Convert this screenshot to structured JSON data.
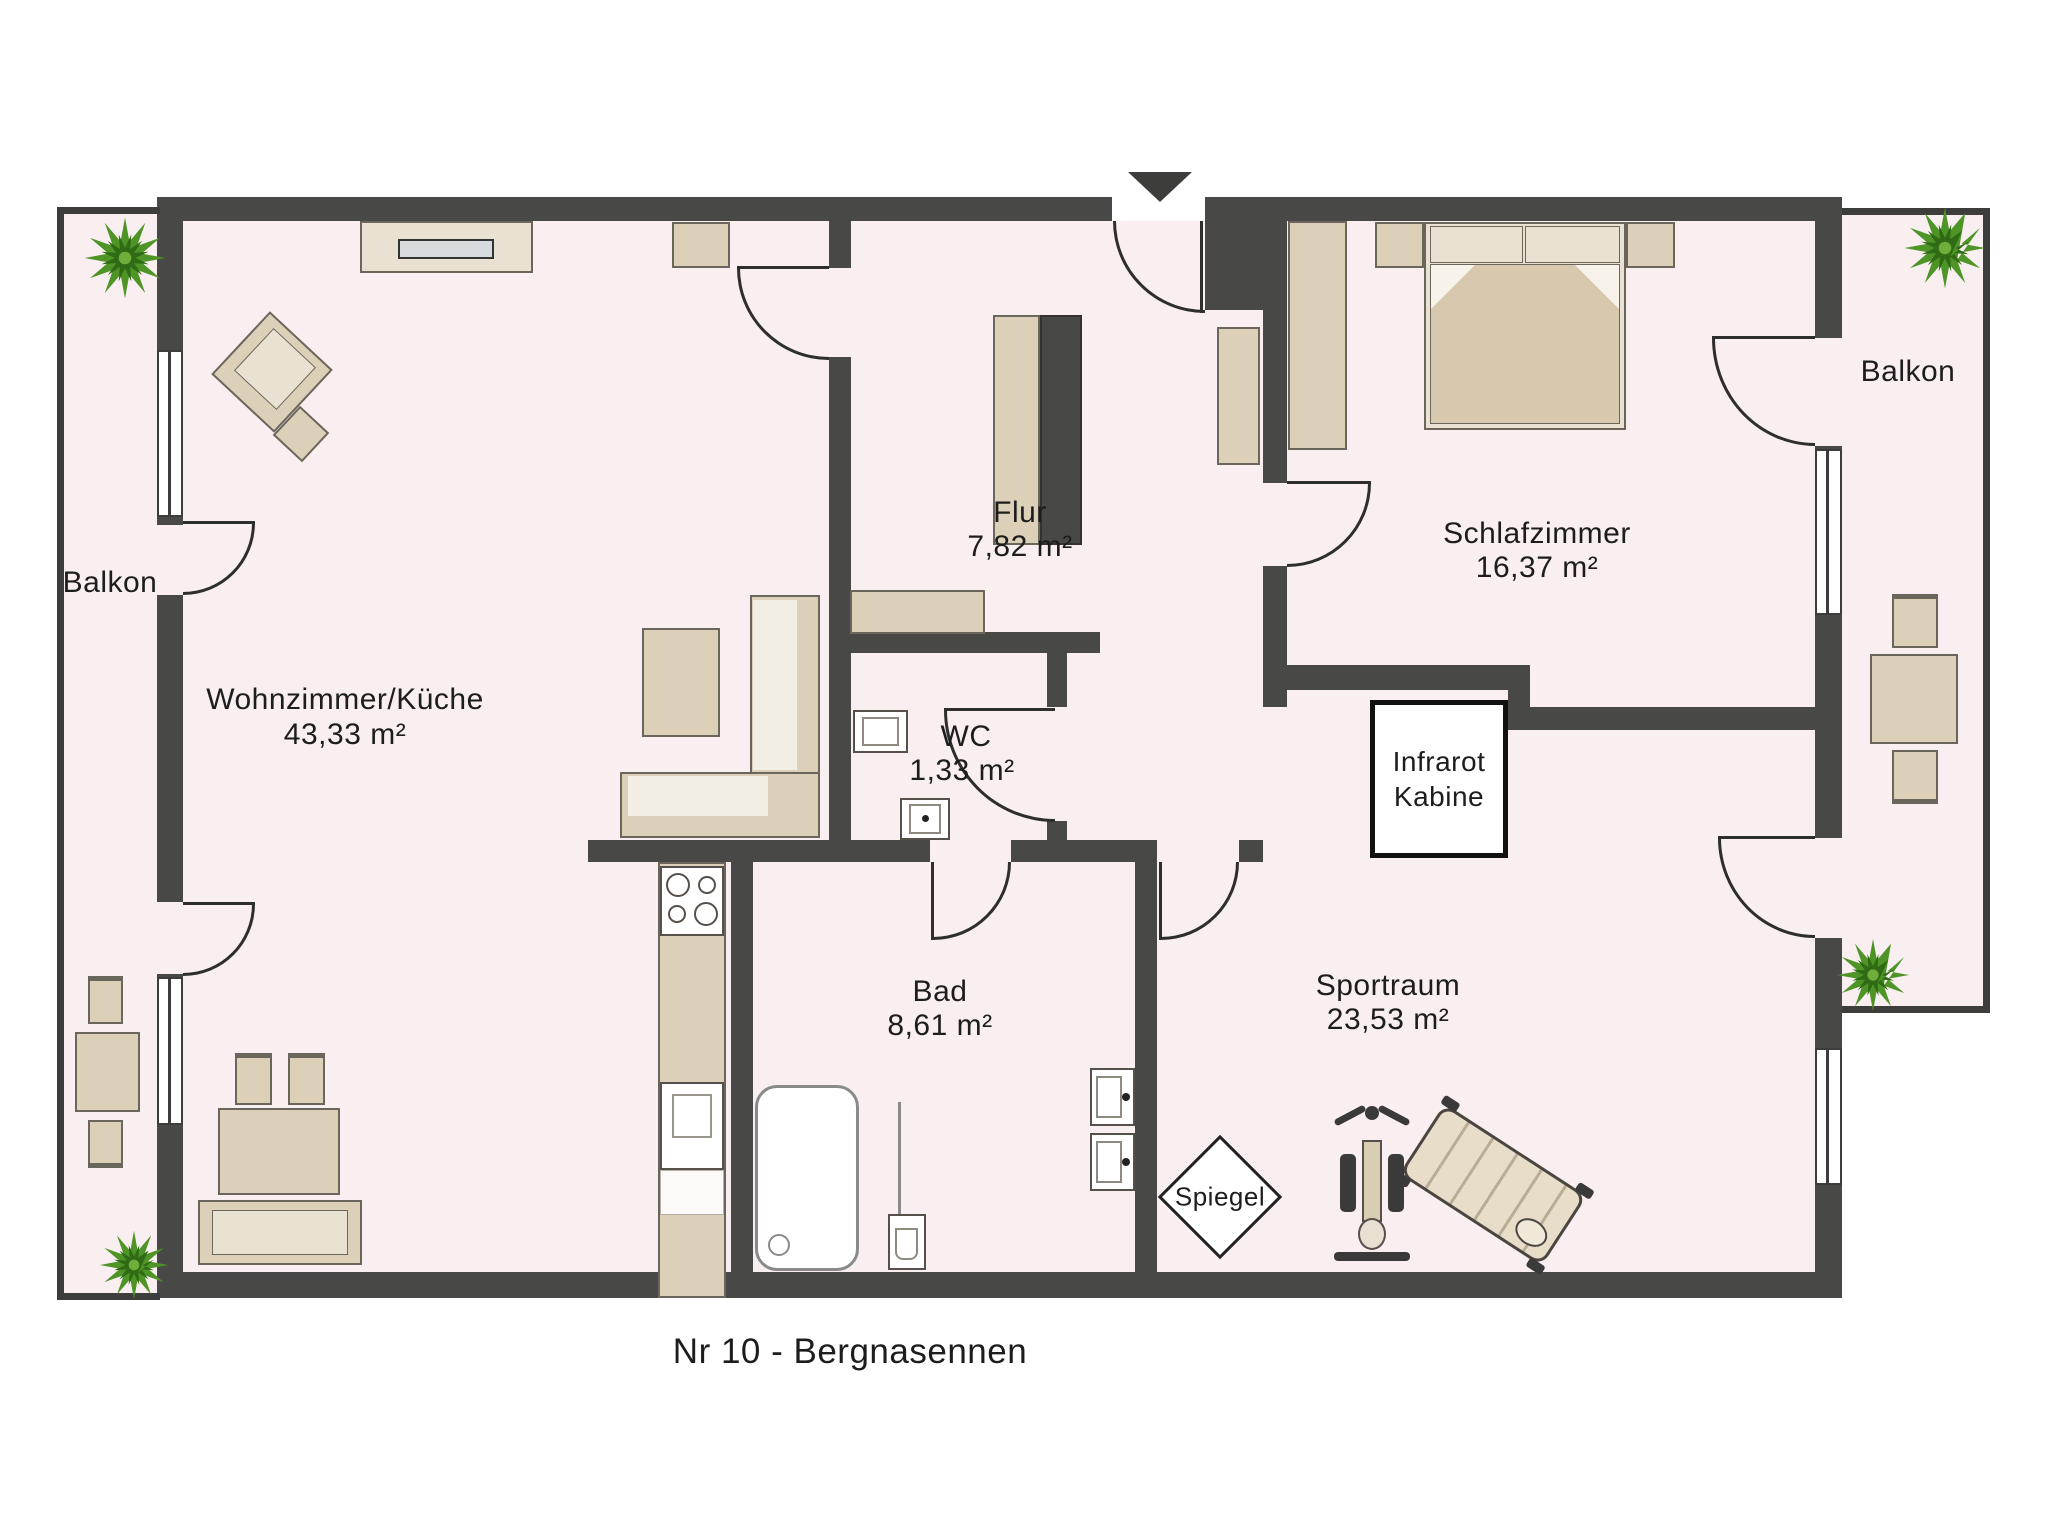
{
  "title": "Nr 10 - Bergnasennen",
  "rooms": {
    "wohnzimmer": {
      "name": "Wohnzimmer/Küche",
      "area": "43,33 m²"
    },
    "flur": {
      "name": "Flur",
      "area": "7,82 m²"
    },
    "wc": {
      "name": "WC",
      "area": "1,33 m²"
    },
    "bad": {
      "name": "Bad",
      "area": "8,61 m²"
    },
    "schlafzimmer": {
      "name": "Schlafzimmer",
      "area": "16,37 m²"
    },
    "sportraum": {
      "name": "Sportraum",
      "area": "23,53 m²"
    },
    "infrarot_kabine": {
      "line1": "Infrarot",
      "line2": "Kabine"
    },
    "balkon_left": {
      "name": "Balkon"
    },
    "balkon_right": {
      "name": "Balkon"
    },
    "spiegel": {
      "label": "Spiegel"
    }
  },
  "colors": {
    "wall": "#484846",
    "floor": "#f9eef0",
    "furniture": "#dcd0b8",
    "furniture_light": "#e9e1d2",
    "plant_green": "#4e9426",
    "plant_dark": "#2f6b14",
    "text": "#1d1d1d"
  }
}
